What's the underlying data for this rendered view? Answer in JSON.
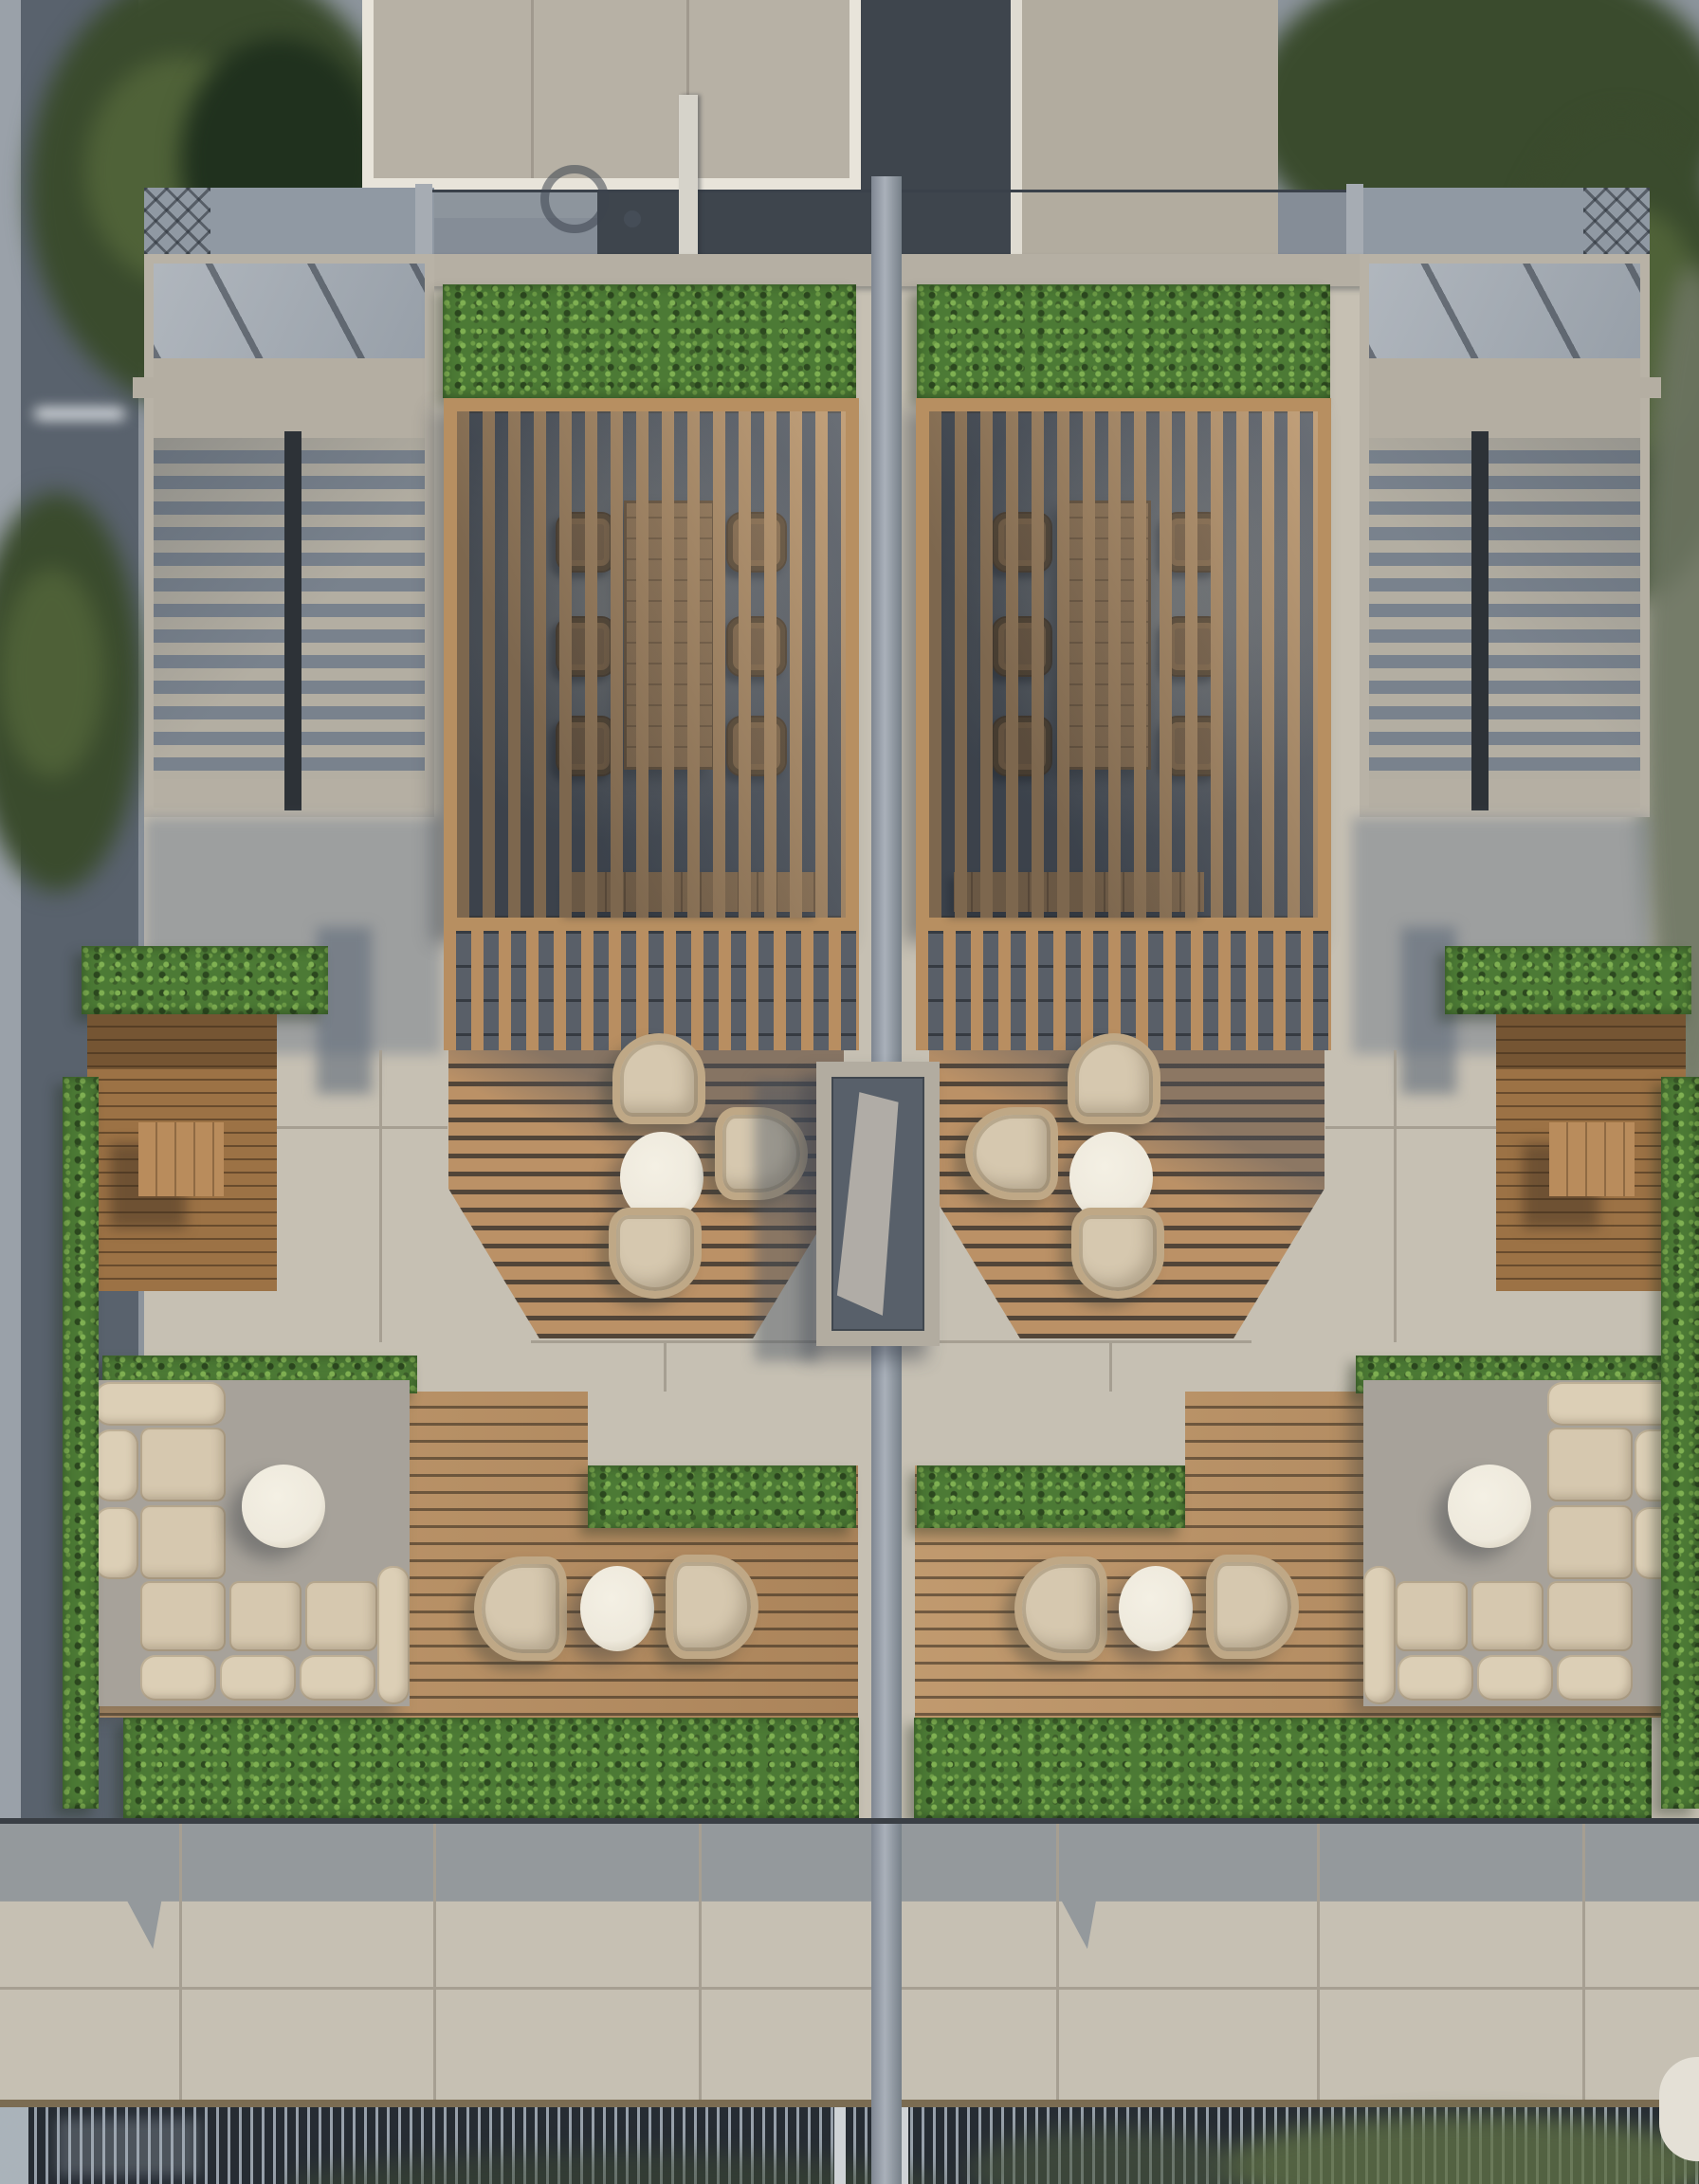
{
  "scene": {
    "type": "aerial architectural rendering",
    "subject": "symmetric duplex rooftop terrace with pergolas, louvered roofs, hedged planters and outdoor lounge furniture",
    "units": 2,
    "objects": [
      "street",
      "trees",
      "neighbor-building-roof",
      "glass-balustrade",
      "terrace-beam",
      "hedge-planters",
      "timber-pergola-left",
      "timber-pergola-right",
      "dining-table",
      "dining-chairs",
      "louvered-skylight-roof-left",
      "louvered-skylight-roof-right",
      "slatted-privacy-screen",
      "mid-terrace-deck",
      "lounge-pod-chairs",
      "oval-coffee-table",
      "central-concrete-planter-box",
      "l-shaped-sofa-left",
      "l-shaped-sofa-right",
      "round-coffee-table",
      "wicker-chair-pair",
      "timber-side-planter-with-bench",
      "perimeter-hedge",
      "concrete-paving-band",
      "street-level-fence",
      "foliage-behind-fence"
    ],
    "furniture_counts": {
      "pergola_dining_chairs_per_unit": 6,
      "lounge_pods_per_unit": 3,
      "sofa_seats_per_unit": 5,
      "wicker_chairs_per_unit": 2
    }
  },
  "palette": {
    "street": "#59626d",
    "sidewalk": "#9aa1a9",
    "treeDark": "#3a4b2d",
    "treeMid": "#55683b",
    "lawn": "#20311e",
    "buildingRoof": "#b7b1a5",
    "fascia": "#e8e4da",
    "darkWall": "#3e454d",
    "lightWall": "#b2ac9f",
    "parapet": "#9099a3",
    "concrete": "#c6c0b3",
    "beam": "#b5afa3",
    "glass": "#9aa2ab",
    "louverLight": "#b3aea2",
    "louverGap": "#79828d",
    "railDark": "#2d3237",
    "hedge": "#4c7a35",
    "hedgeLight": "#7fb052",
    "hedgeShadow": "#2c481f",
    "pergolaWood": "#b78f61",
    "interiorGray": "#595f68",
    "tableWood": "#b2895b",
    "chairWood": "#93704a",
    "deckWood": "#b88e61",
    "paving": "#c6c0b3",
    "pavingJoint": "#a69f92",
    "cushion": "#d6c8af",
    "tableWhite": "#eee9dc",
    "rattan": "#bfa886",
    "sofaPad": "#a7a29a",
    "planterWood": "#9c7245",
    "boxFrame": "#b2aca0",
    "boxInner": "#58606a",
    "bandShadow": "#6c7888",
    "fenceDark": "#262c33",
    "fenceBar": "#97a0aa",
    "foliage": "#5f7046"
  }
}
